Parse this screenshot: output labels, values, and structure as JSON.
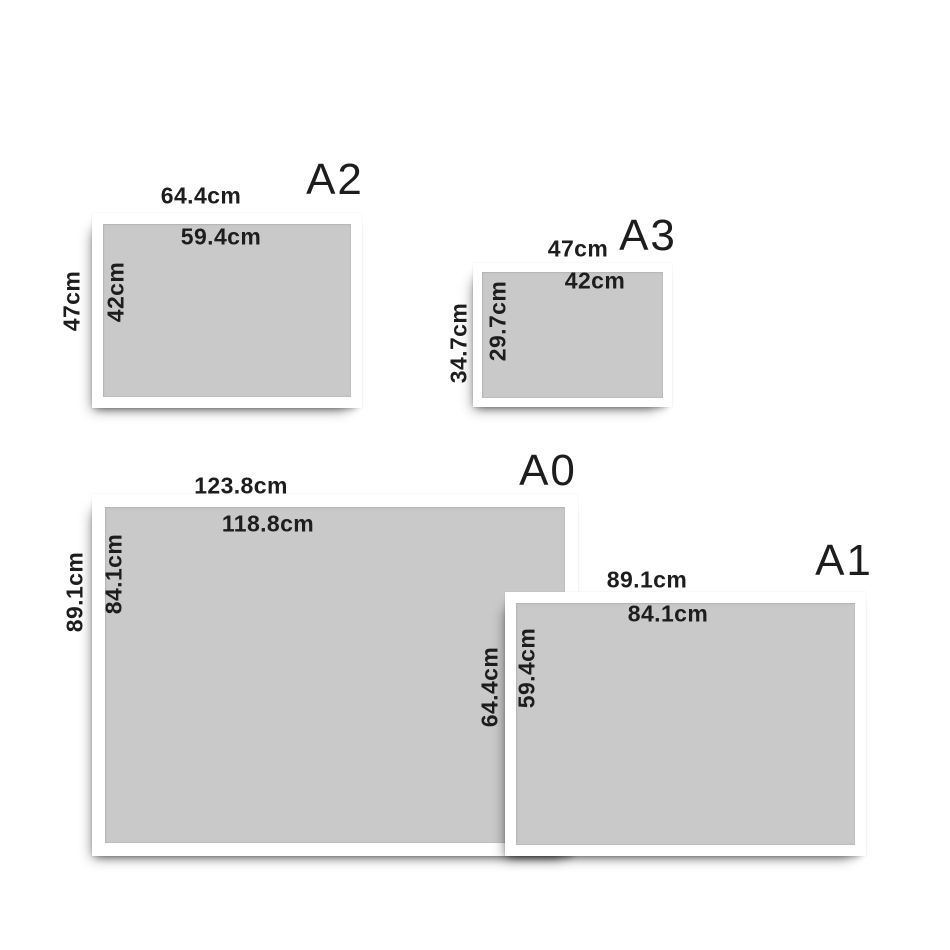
{
  "colors": {
    "background": "#ffffff",
    "frame_white": "#ffffff",
    "paper_gray": "#c9c9c9",
    "text": "#1d1d1d"
  },
  "frames": [
    {
      "label": "A2",
      "outer_width": "64.4cm",
      "inner_width": "59.4cm",
      "outer_height": "47cm",
      "inner_height": "42cm"
    },
    {
      "label": "A3",
      "outer_width": "47cm",
      "inner_width": "42cm",
      "outer_height": "34.7cm",
      "inner_height": "29.7cm"
    },
    {
      "label": "A0",
      "outer_width": "123.8cm",
      "inner_width": "118.8cm",
      "outer_height": "89.1cm",
      "inner_height": "84.1cm"
    },
    {
      "label": "A1",
      "outer_width": "89.1cm",
      "inner_width": "84.1cm",
      "outer_height": "64.4cm",
      "inner_height": "59.4cm"
    }
  ]
}
